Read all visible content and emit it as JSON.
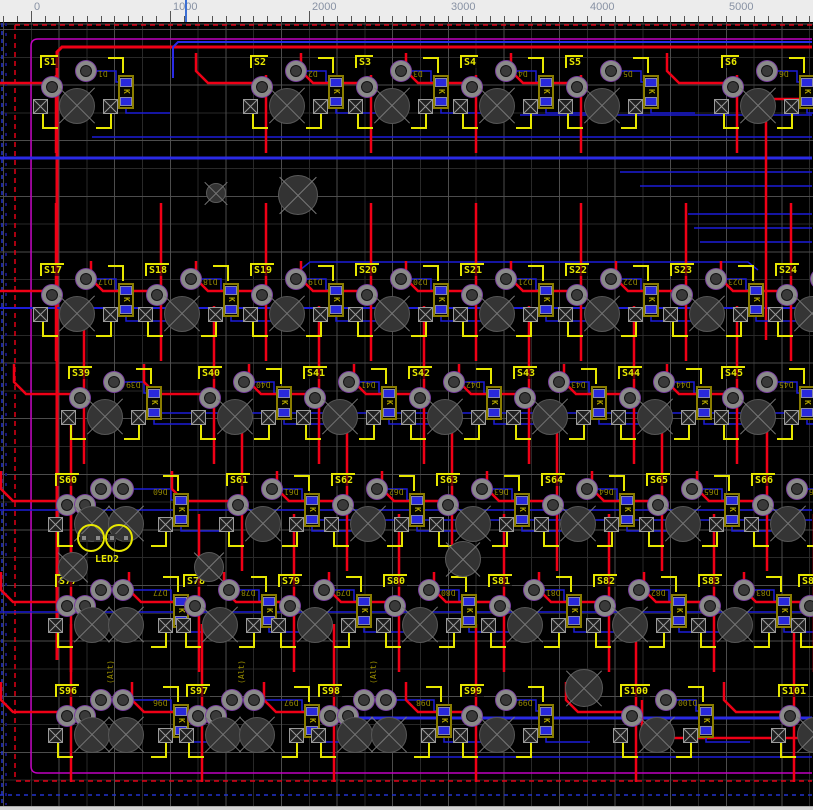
{
  "app": {
    "title": "PCB layout editor canvas"
  },
  "ruler": {
    "unit_labels": [
      "0",
      "1000",
      "2000",
      "3000",
      "4000",
      "5000"
    ],
    "origin_x": 31,
    "px_per_1000": 139,
    "cursor_x": 185
  },
  "colors": {
    "background": "#000000",
    "grid_minor": "#2d2d2d",
    "grid_major": "#525252",
    "trace_red": "#ef0016",
    "trace_blue": "#1c1cd8",
    "trace_blue_bright": "#2a2ae6",
    "edge_magenta": "#c000c0",
    "edge_red_dashed": "#e00016",
    "edge_blue_dashed": "#2233cc",
    "silk_yellow": "#e6e600",
    "fab_olive": "#8f8400",
    "pad_ring": "#8a8a8a",
    "pad_outline": "#7a3fa0",
    "smd_blue": "#2828dc",
    "ruler_text": "#8892a4",
    "cursor_blue": "#3b6fd4"
  },
  "board": {
    "rows": [
      {
        "y": 57,
        "switches": [
          {
            "label": "S1",
            "x": 42,
            "diode": "D1"
          },
          {
            "label": "S2",
            "x": 252,
            "diode": "D2"
          },
          {
            "label": "S3",
            "x": 357,
            "diode": "D3"
          },
          {
            "label": "S4",
            "x": 462,
            "diode": "D4"
          },
          {
            "label": "S5",
            "x": 567,
            "diode": "D5"
          },
          {
            "label": "S6",
            "x": 723,
            "diode": "D6"
          }
        ]
      },
      {
        "y": 265,
        "switches": [
          {
            "label": "S17",
            "x": 42,
            "diode": "D17"
          },
          {
            "label": "S18",
            "x": 147,
            "diode": "D18"
          },
          {
            "label": "S19",
            "x": 252,
            "diode": "D19"
          },
          {
            "label": "S20",
            "x": 357,
            "diode": "D20"
          },
          {
            "label": "S21",
            "x": 462,
            "diode": "D21"
          },
          {
            "label": "S22",
            "x": 567,
            "diode": "D22"
          },
          {
            "label": "S23",
            "x": 672,
            "diode": "D23"
          },
          {
            "label": "S24",
            "x": 777,
            "diode": "D24"
          }
        ]
      },
      {
        "y": 368,
        "switches": [
          {
            "label": "S39",
            "x": 70,
            "diode": "D39"
          },
          {
            "label": "S40",
            "x": 200,
            "diode": "D40"
          },
          {
            "label": "S41",
            "x": 305,
            "diode": "D41"
          },
          {
            "label": "S42",
            "x": 410,
            "diode": "D42"
          },
          {
            "label": "S43",
            "x": 515,
            "diode": "D43"
          },
          {
            "label": "S44",
            "x": 620,
            "diode": "D44"
          },
          {
            "label": "S45",
            "x": 723,
            "diode": "D45"
          }
        ]
      },
      {
        "y": 475,
        "switches": [
          {
            "label": "S60",
            "x": 57,
            "diode": "D60",
            "wide": true
          },
          {
            "label": "S61",
            "x": 228,
            "diode": "D61"
          },
          {
            "label": "S62",
            "x": 333,
            "diode": "D62"
          },
          {
            "label": "S63",
            "x": 438,
            "diode": "D63"
          },
          {
            "label": "S64",
            "x": 543,
            "diode": "D64"
          },
          {
            "label": "S65",
            "x": 648,
            "diode": "D65"
          },
          {
            "label": "S66",
            "x": 753,
            "diode": "D66"
          }
        ]
      },
      {
        "y": 576,
        "switches": [
          {
            "label": "S77",
            "x": 57,
            "diode": "D77",
            "wide": true
          },
          {
            "label": "S78",
            "x": 185,
            "diode": "D78"
          },
          {
            "label": "S79",
            "x": 280,
            "diode": "D79"
          },
          {
            "label": "S80",
            "x": 385,
            "diode": "D80"
          },
          {
            "label": "S81",
            "x": 490,
            "diode": "D81"
          },
          {
            "label": "S82",
            "x": 595,
            "diode": "D82"
          },
          {
            "label": "S83",
            "x": 700,
            "diode": "D83"
          },
          {
            "label": "S84",
            "x": 800,
            "diode": "D84"
          }
        ]
      },
      {
        "y": 686,
        "switches": [
          {
            "label": "S96",
            "x": 57,
            "diode": "D96",
            "wide": true,
            "caption": "(Alt)"
          },
          {
            "label": "S97",
            "x": 188,
            "diode": "D97",
            "wide": true,
            "caption": "(Alt)"
          },
          {
            "label": "S98",
            "x": 320,
            "diode": "D98",
            "wide": true,
            "caption": "(Alt)"
          },
          {
            "label": "S99",
            "x": 462,
            "diode": "D99"
          },
          {
            "label": "S100",
            "x": 622,
            "diode": "D100"
          },
          {
            "label": "S101",
            "x": 780,
            "diode": "D101"
          }
        ]
      }
    ],
    "led": {
      "label": "LED2",
      "x": 91,
      "y": 538
    },
    "holes": [
      {
        "x": 215,
        "y": 192,
        "r": 9
      },
      {
        "x": 297,
        "y": 194,
        "r": 19
      },
      {
        "x": 72,
        "y": 566,
        "r": 14
      },
      {
        "x": 208,
        "y": 566,
        "r": 14
      },
      {
        "x": 462,
        "y": 558,
        "r": 17
      },
      {
        "x": 583,
        "y": 687,
        "r": 18
      }
    ]
  }
}
